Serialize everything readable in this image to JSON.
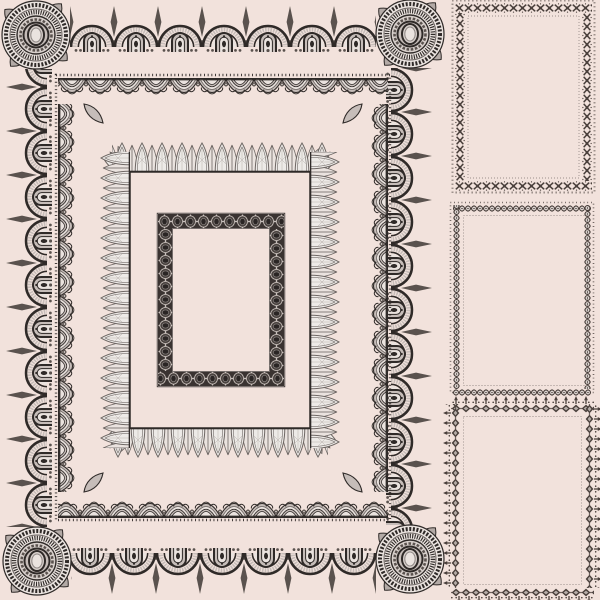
{
  "colors": {
    "background": "#f2e2dc",
    "ink": "#2f2a28",
    "mid": "#5a524e",
    "soft": "#c6bdb9",
    "pale": "#eae3df",
    "petal": "#edeae7",
    "petalline": "#6d6663",
    "banddark": "#3a3331",
    "stitch": "#4a403c",
    "disc": "#d7cfcb"
  },
  "artwork": {
    "kind": "vintage ornamental lace frame set",
    "main_frame": {
      "borders": [
        "outer arched lace band with horseshoe arches and spire finials",
        "scalloped net lace band with corner leaves",
        "petal fan band on thin base rule",
        "dark guilloche ellipse band"
      ],
      "corner_ornaments": "round medallions with paisley swirls"
    },
    "side_frames": [
      {
        "position": "top",
        "border": "cross-stitch X motifs with bead fringe"
      },
      {
        "position": "middle",
        "border": "chain-link beads with dotted fringe"
      },
      {
        "position": "bottom",
        "border": "diamond chain with outward fleur spikes"
      }
    ]
  }
}
